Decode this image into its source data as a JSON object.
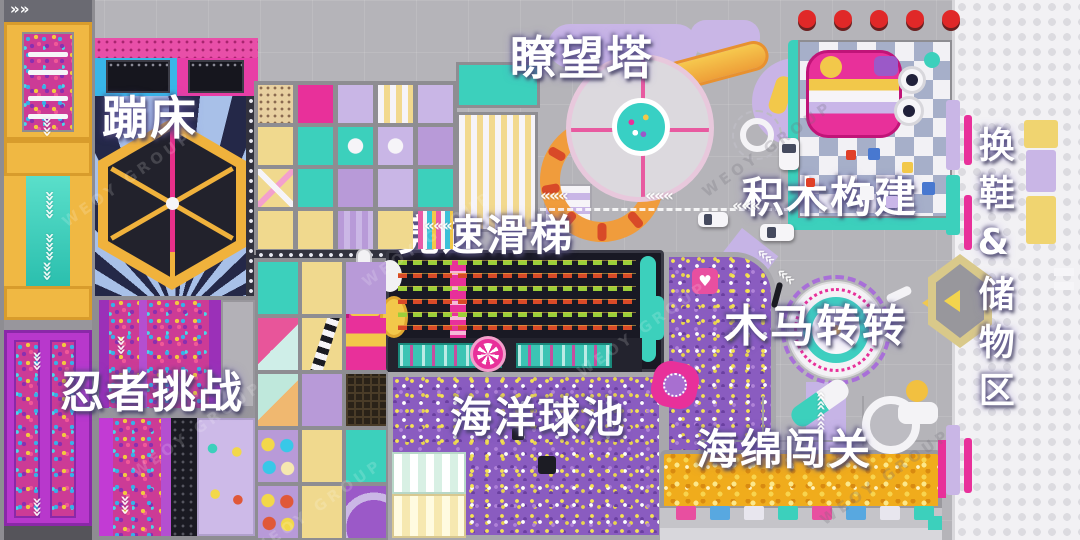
{
  "zones": [
    {
      "id": "trampoline",
      "label": "蹦床"
    },
    {
      "id": "watchtower",
      "label": "瞭望塔"
    },
    {
      "id": "racing-slide",
      "label": "竞速滑梯"
    },
    {
      "id": "building-blocks",
      "label": "积木构建"
    },
    {
      "id": "carousel",
      "label": "木马转转"
    },
    {
      "id": "ninja-challenge",
      "label": "忍者挑战"
    },
    {
      "id": "ocean-ball-pit",
      "label": "海洋球池"
    },
    {
      "id": "sponge-course",
      "label": "海绵闯关"
    },
    {
      "id": "shoe-storage",
      "label": "换鞋&储物区"
    }
  ],
  "watermark": "WEOY GROUP",
  "icons": {
    "road_chevron": "«",
    "double_arrow": "»",
    "heart": "♥"
  },
  "colors": {
    "magenta": "#e8309a",
    "teal": "#3cd0bc",
    "yellow": "#f0b843",
    "lavender": "#c9b6e6",
    "purple": "#9b59c8",
    "navy": "#20202e",
    "orange": "#f09c3c",
    "red": "#e02828",
    "floor": "#b5b4b9"
  }
}
